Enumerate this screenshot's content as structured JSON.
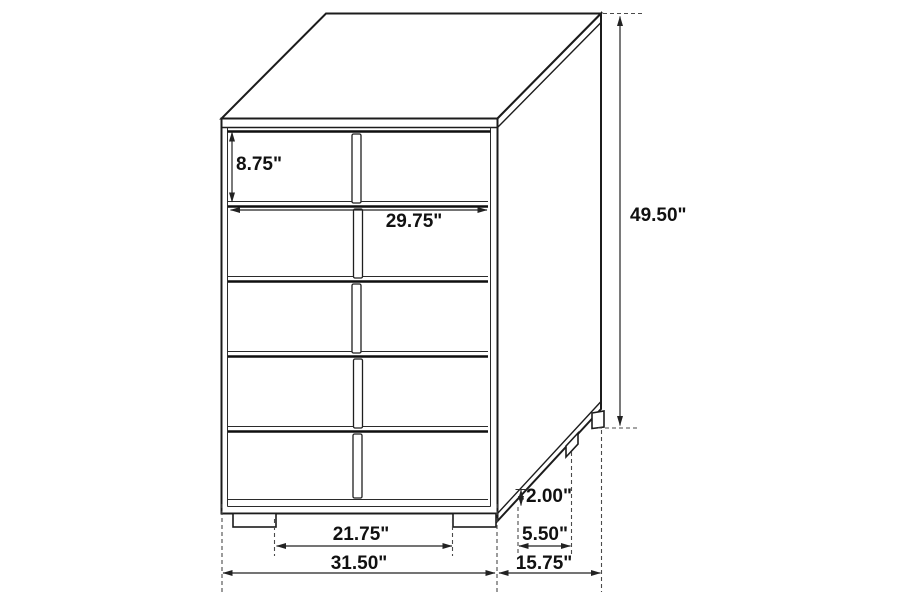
{
  "diagram": {
    "subject": "five-drawer-chest-dimension-diagram",
    "units": "inches",
    "dimensions": {
      "top_drawer_height": "8.75\"",
      "drawer_width": "29.75\"",
      "overall_height": "49.50\"",
      "foot_height": "2.00\"",
      "side_foot_depth": "5.50\"",
      "front_feet_spacing": "21.75\"",
      "overall_width": "31.50\"",
      "overall_depth": "15.75\""
    },
    "colors": {
      "background": "#ffffff",
      "line": "#1c1c1c",
      "dashed_line": "#4a4a4a",
      "label_text": "#111111"
    }
  }
}
